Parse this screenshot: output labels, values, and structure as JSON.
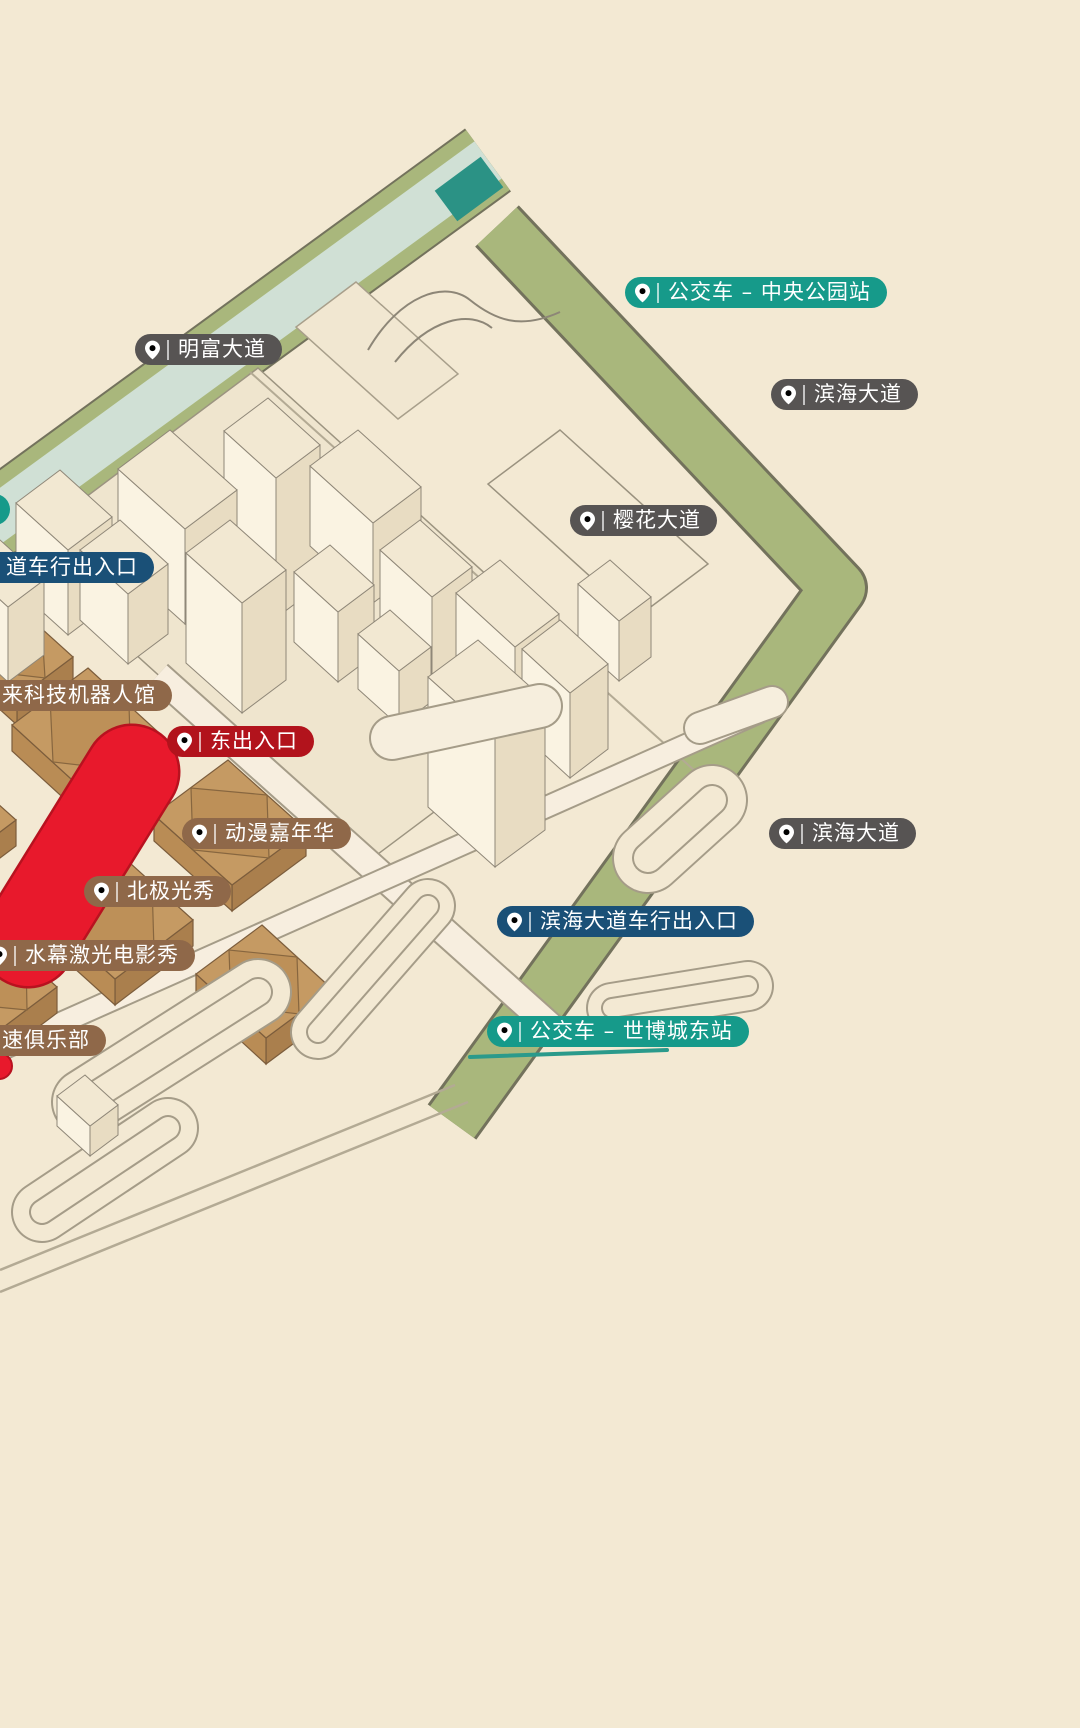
{
  "map": {
    "type": "isometric-park-map",
    "colors": {
      "background": "#f3e9d3",
      "label_teal": "#169A8A",
      "label_gray": "#575453",
      "label_blue": "#1A5077",
      "label_red": "#B2131C",
      "label_brown": "#8F6849",
      "greenway": "#a9b77c",
      "canal_water": "#d0e0d5",
      "canal_dark_teal": "#2b9285",
      "building_cream": "#f2e8d2",
      "pavilion_tan": "#c59a63",
      "landmark_red": "#e8192c"
    },
    "labels": [
      {
        "name": "bus-stop-central-park",
        "text": "公交车 – 中央公园站",
        "color": "teal",
        "x": 625,
        "y": 277,
        "pin": true
      },
      {
        "name": "road-mingfu-avenue",
        "text": "明富大道",
        "color": "gray",
        "x": 135,
        "y": 334,
        "pin": true
      },
      {
        "name": "road-binhai-avenue-north",
        "text": "滨海大道",
        "color": "gray",
        "x": 771,
        "y": 379,
        "pin": true
      },
      {
        "name": "road-yinghua-avenue",
        "text": "樱花大道",
        "color": "gray",
        "x": 570,
        "y": 505,
        "pin": true
      },
      {
        "name": "bus-stop-partial",
        "text": "",
        "color": "teal",
        "x": -21,
        "y": 494,
        "pin": false,
        "sliver": true
      },
      {
        "name": "exit-vehicle-northwest",
        "text": "道车行出入口",
        "color": "blue",
        "x": -37,
        "y": 552,
        "pin": true
      },
      {
        "name": "pavilion-future-tech-robot",
        "text": "来科技机器人馆",
        "color": "brown",
        "x": -41,
        "y": 680,
        "pin": true
      },
      {
        "name": "exit-east",
        "text": "东出入口",
        "color": "red",
        "x": 167,
        "y": 726,
        "pin": true
      },
      {
        "name": "attraction-anime-carnival",
        "text": "动漫嘉年华",
        "color": "brown",
        "x": 182,
        "y": 818,
        "pin": true
      },
      {
        "name": "attraction-aurora-show",
        "text": "北极光秀",
        "color": "brown",
        "x": 84,
        "y": 876,
        "pin": true
      },
      {
        "name": "attraction-water-laser-movie-show",
        "text": "水幕激光电影秀",
        "color": "brown",
        "x": -18,
        "y": 940,
        "pin": true
      },
      {
        "name": "attraction-speed-club",
        "text": "速俱乐部",
        "color": "brown",
        "x": -41,
        "y": 1025,
        "pin": true
      },
      {
        "name": "road-binhai-avenue-east",
        "text": "滨海大道",
        "color": "gray",
        "x": 769,
        "y": 818,
        "pin": true
      },
      {
        "name": "exit-binhai-vehicle",
        "text": "滨海大道车行出入口",
        "color": "blue",
        "x": 497,
        "y": 906,
        "pin": true
      },
      {
        "name": "bus-stop-expo-city-east",
        "text": "公交车 – 世博城东站",
        "color": "teal",
        "x": 487,
        "y": 1016,
        "pin": true
      }
    ]
  }
}
